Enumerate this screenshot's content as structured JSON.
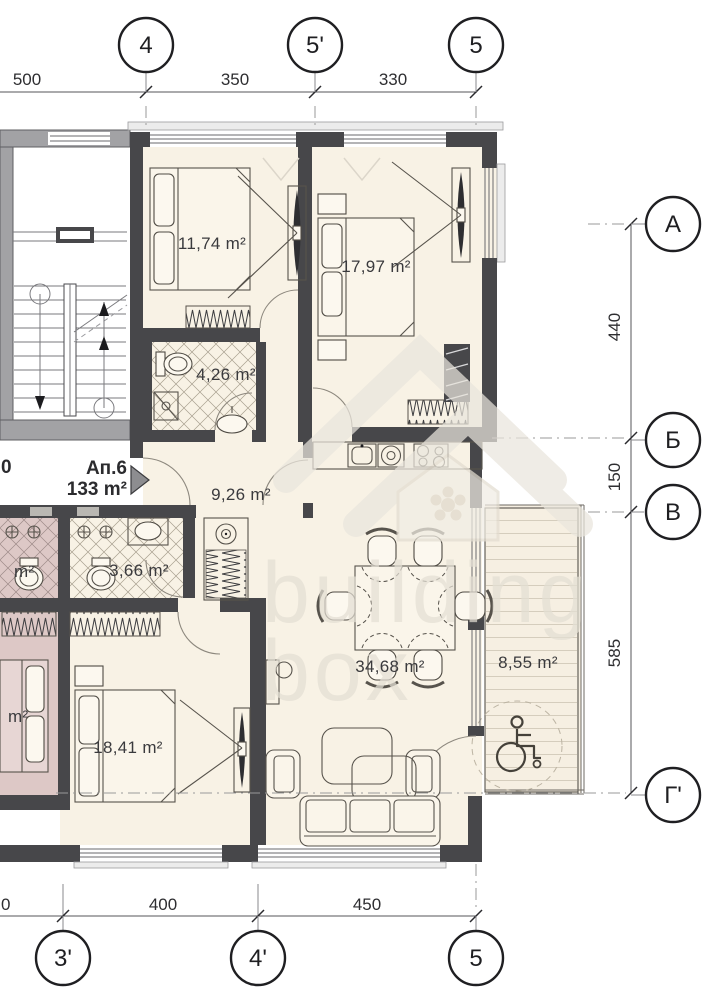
{
  "watermark": {
    "line1": "building",
    "line2": "box"
  },
  "apartment": {
    "label": "Ап.6",
    "area": "133 m²",
    "partial_left_text": "0"
  },
  "rooms": {
    "bedroom_top_left": "11,74 m²",
    "bedroom_top_right": "17,97 m²",
    "bathroom_top": "4,26 m²",
    "hallway": "9,26 m²",
    "bathroom_small": "3,66 m²",
    "bedroom_bottom": "18,41 m²",
    "living_kitchen": "34,68 m²",
    "terrace": "8,55 m²",
    "neighbor_bathroom_partial": "m²",
    "neighbor_room_partial": "m²"
  },
  "axes": {
    "top": [
      {
        "label": "4"
      },
      {
        "label": "5'"
      },
      {
        "label": "5"
      }
    ],
    "right": [
      {
        "label": "A"
      },
      {
        "label": "Б"
      },
      {
        "label": "B"
      },
      {
        "label": "Г'"
      }
    ],
    "bottom": [
      {
        "label": "3'"
      },
      {
        "label": "4'"
      },
      {
        "label": "5"
      }
    ]
  },
  "dimensions": {
    "top": [
      "500",
      "350",
      "330"
    ],
    "right": [
      "440",
      "150",
      "585"
    ],
    "bottom": [
      "400",
      "450"
    ],
    "bottom_partial": "0"
  },
  "colors": {
    "wall": "#47474a",
    "room_fill": "#f8f2e5",
    "neighbor_fill": "#ddc8c6",
    "terrace_fill": "#f6efe2",
    "watermark": "#e4dfd4"
  }
}
